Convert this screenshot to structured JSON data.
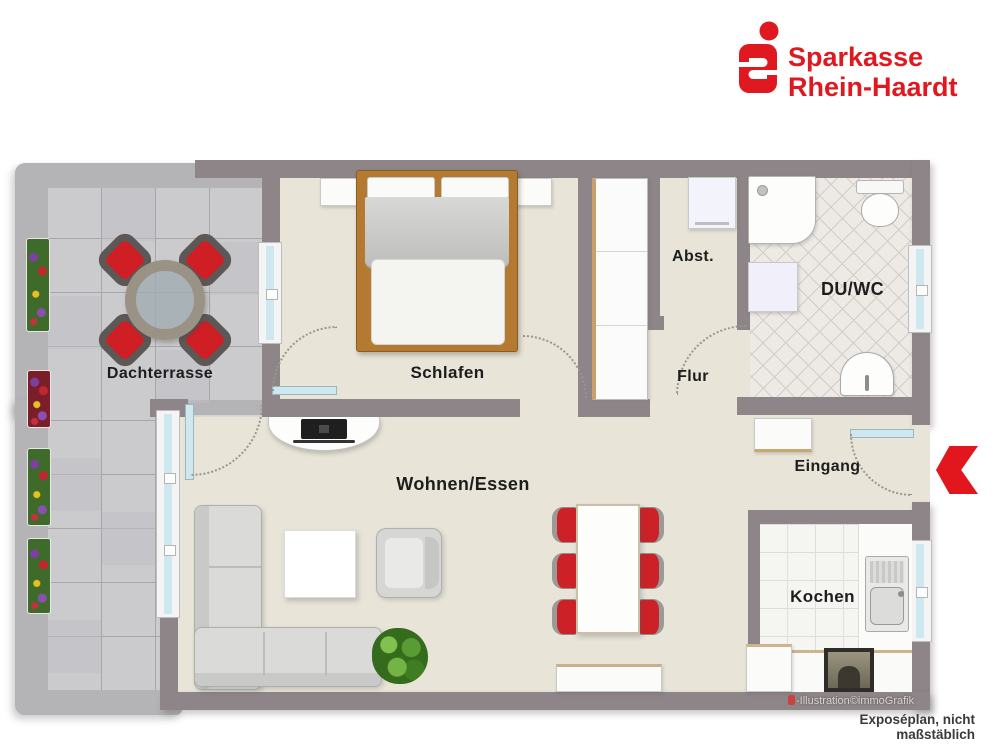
{
  "brand": {
    "line1": "Sparkasse",
    "line2": "Rhein-Haardt"
  },
  "plan": {
    "rooms": {
      "dachterrasse": "Dachterrasse",
      "schlafen": "Schlafen",
      "abstellraum": "Abst.",
      "du_wc": "DU/WC",
      "flur": "Flur",
      "wohnen_essen": "Wohnen/Essen",
      "eingang": "Eingang",
      "kochen": "Kochen"
    }
  },
  "footer": {
    "credit": "-Illustration©immoGrafik",
    "disclaimer": "Exposéplan, nicht maßstäblich"
  },
  "colors": {
    "brand_red": "#e0181f",
    "accent_red": "#cf1b20",
    "wall": "#8d8587",
    "floor": "#e8e4d8",
    "terrace_tile": "#cbcbce",
    "terrace_border": "#b4b4b6",
    "window_glass": "#cfe7ef"
  }
}
